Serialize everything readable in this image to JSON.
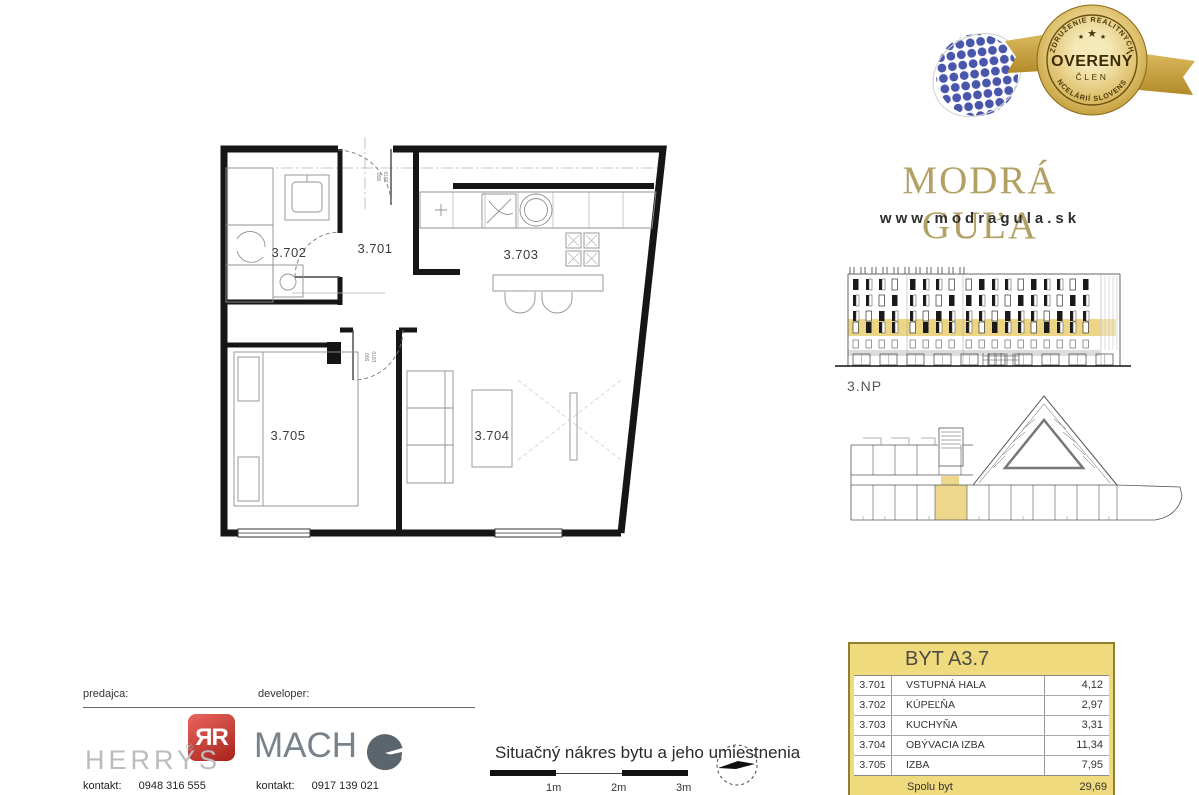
{
  "badge": {
    "arc_top": "ZDRUŽENIE REALITNÝCH",
    "arc_bottom": "KANCELÁRIÍ SLOVENSKA",
    "center": "OVERENÝ",
    "member": "ČLEN",
    "star": "★",
    "gold_color": "#c9a83e",
    "globe_color": "#4956ac"
  },
  "brand": {
    "title": "MODRÁ GUĽA",
    "website": "www.modragula.sk",
    "title_color": "#b2a163"
  },
  "elevation": {
    "floor_label": "3.NP",
    "highlight_color": "#ecd685"
  },
  "site_plan": {
    "highlight_color": "#ecd78a"
  },
  "floor_plan": {
    "rooms": [
      {
        "label": "3.701"
      },
      {
        "label": "3.702"
      },
      {
        "label": "3.703"
      },
      {
        "label": "3.704"
      },
      {
        "label": "3.705"
      }
    ],
    "door_dims": [
      "900",
      "1970"
    ]
  },
  "table": {
    "title": "BYT A3.7",
    "header_bg": "#f0da7e",
    "rows": [
      {
        "code": "3.701",
        "name": "VSTUPNÁ HALA",
        "area": "4,12"
      },
      {
        "code": "3.702",
        "name": "KÚPEĽŇA",
        "area": "2,97"
      },
      {
        "code": "3.703",
        "name": "KUCHYŇA",
        "area": "3,31"
      },
      {
        "code": "3.704",
        "name": "OBÝVACIA IZBA",
        "area": "11,34"
      },
      {
        "code": "3.705",
        "name": "IZBA",
        "area": "7,95"
      }
    ],
    "total_label": "Spolu byt",
    "total_value": "29,69"
  },
  "footer": {
    "seller_label": "predajca:",
    "developer_label": "developer:",
    "herrys": {
      "monogram": "ЯR",
      "name": "HERRYS",
      "reg": "®",
      "contact_label": "kontakt:",
      "phone": "0948 316 555"
    },
    "macho": {
      "name": "MACH",
      "contact_label": "kontakt:",
      "phone": "0917 139 021"
    },
    "caption": "Situačný nákres bytu a jeho umiestnenia",
    "scale_labels": [
      "1m",
      "2m",
      "3m"
    ]
  }
}
